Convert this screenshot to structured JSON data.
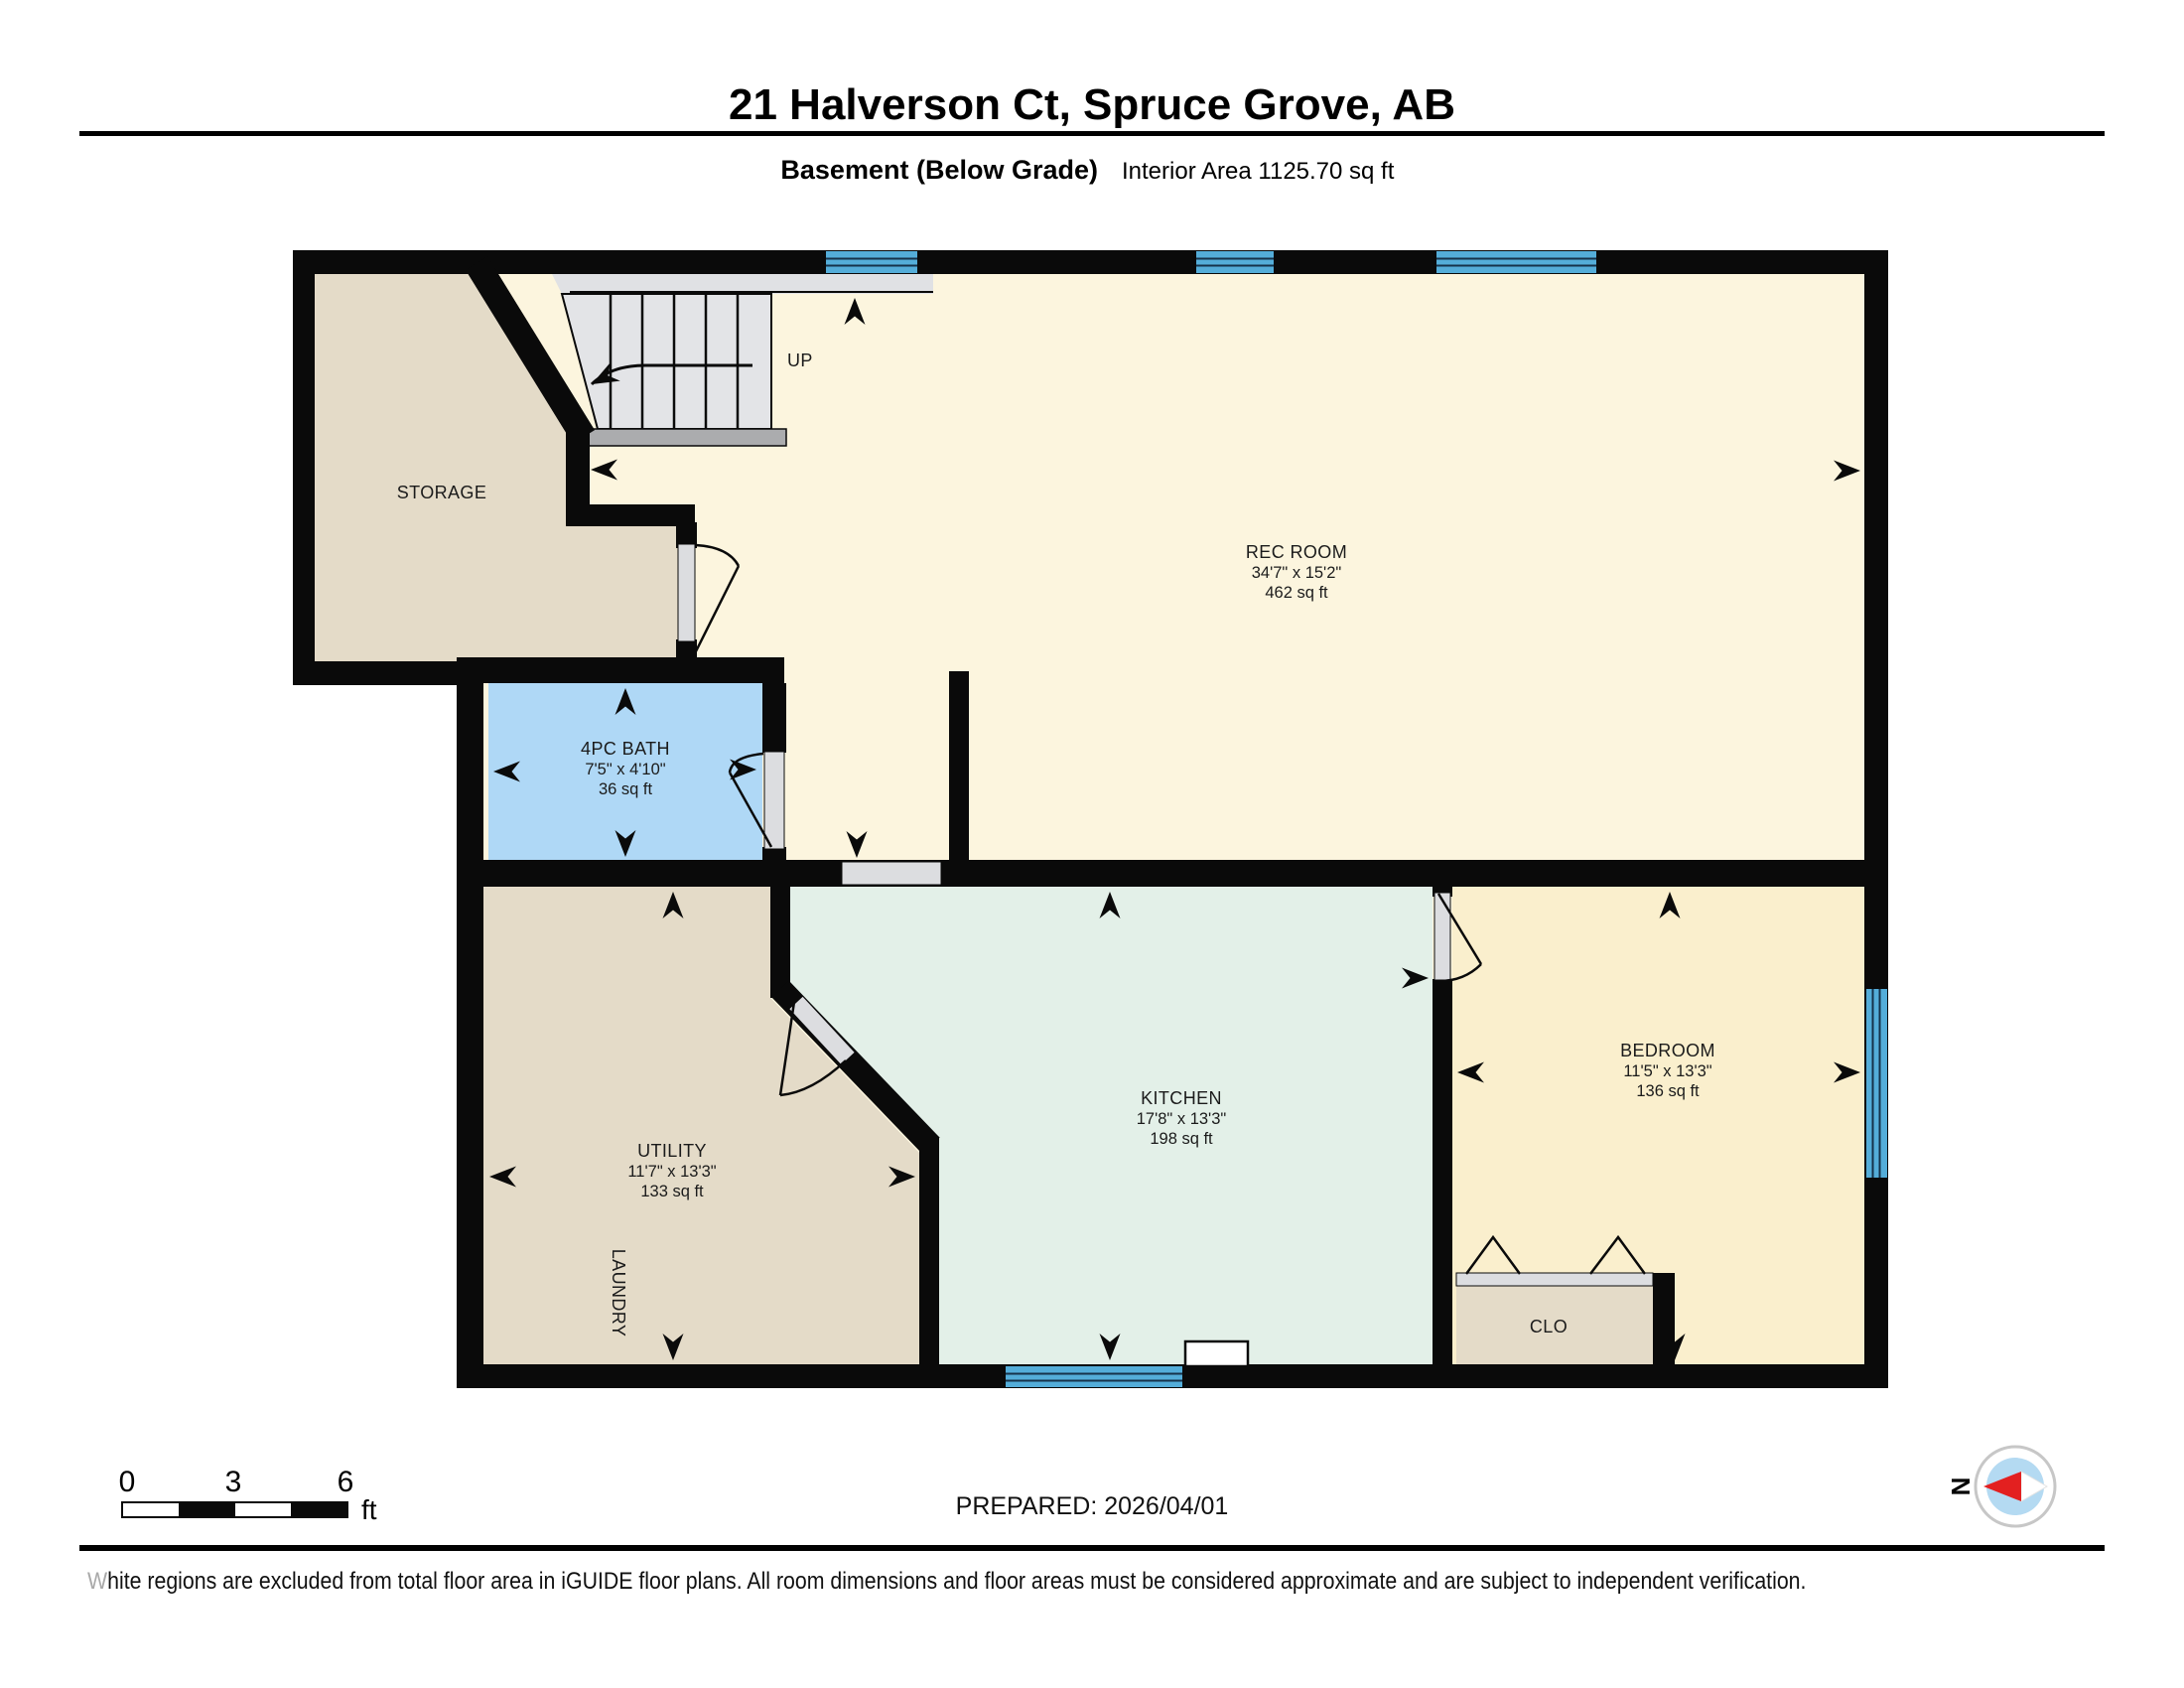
{
  "header": {
    "title": "21 Halverson Ct, Spruce Grove, AB",
    "floor_label": "Basement (Below Grade)",
    "area_label": "Interior Area 1125.70 sq ft"
  },
  "rooms": {
    "storage": {
      "name": "STORAGE"
    },
    "rec_room": {
      "name": "REC ROOM",
      "dims": "34'7\" x 15'2\"",
      "area": "462 sq ft"
    },
    "bath": {
      "name": "4PC BATH",
      "dims": "7'5\" x 4'10\"",
      "area": "36 sq ft"
    },
    "utility": {
      "name": "UTILITY",
      "dims": "11'7\" x 13'3\"",
      "area": "133 sq ft",
      "sub_label": "LAUNDRY"
    },
    "kitchen": {
      "name": "KITCHEN",
      "dims": "17'8\" x 13'3\"",
      "area": "198 sq ft"
    },
    "bedroom": {
      "name": "BEDROOM",
      "dims": "11'5\" x 13'3\"",
      "area": "136 sq ft"
    },
    "closet": {
      "name": "CLO"
    }
  },
  "stairs": {
    "direction_label": "UP"
  },
  "scale_bar": {
    "tick_0": "0",
    "tick_1": "3",
    "tick_2": "6",
    "unit": "ft"
  },
  "compass": {
    "north_label": "N"
  },
  "footer": {
    "prepared": "PREPARED: 2026/04/01",
    "disclaimer_lead": "W",
    "disclaimer_rest": "hite regions are excluded from total floor area in iGUIDE floor plans. All room dimensions and floor areas must be considered approximate and are subject to independent verification."
  },
  "colors": {
    "wall": "#0a0a0a",
    "rec_room": "#FCF5DE",
    "bedroom": "#FAEFCD",
    "kitchen": "#E3F0E8",
    "bath": "#AFD8F6",
    "tan": "#E4DBC8",
    "stairs": "#E3E4E7",
    "stairs_strip": "#E0E1E4",
    "landing": "#ABACAE",
    "threshold": "#DCDDE0",
    "window": "#54ADD9",
    "window_line": "#16324A",
    "compass_red": "#E32020",
    "compass_inner": "#B4DAF2",
    "gray_text": "#A9A9A9"
  }
}
